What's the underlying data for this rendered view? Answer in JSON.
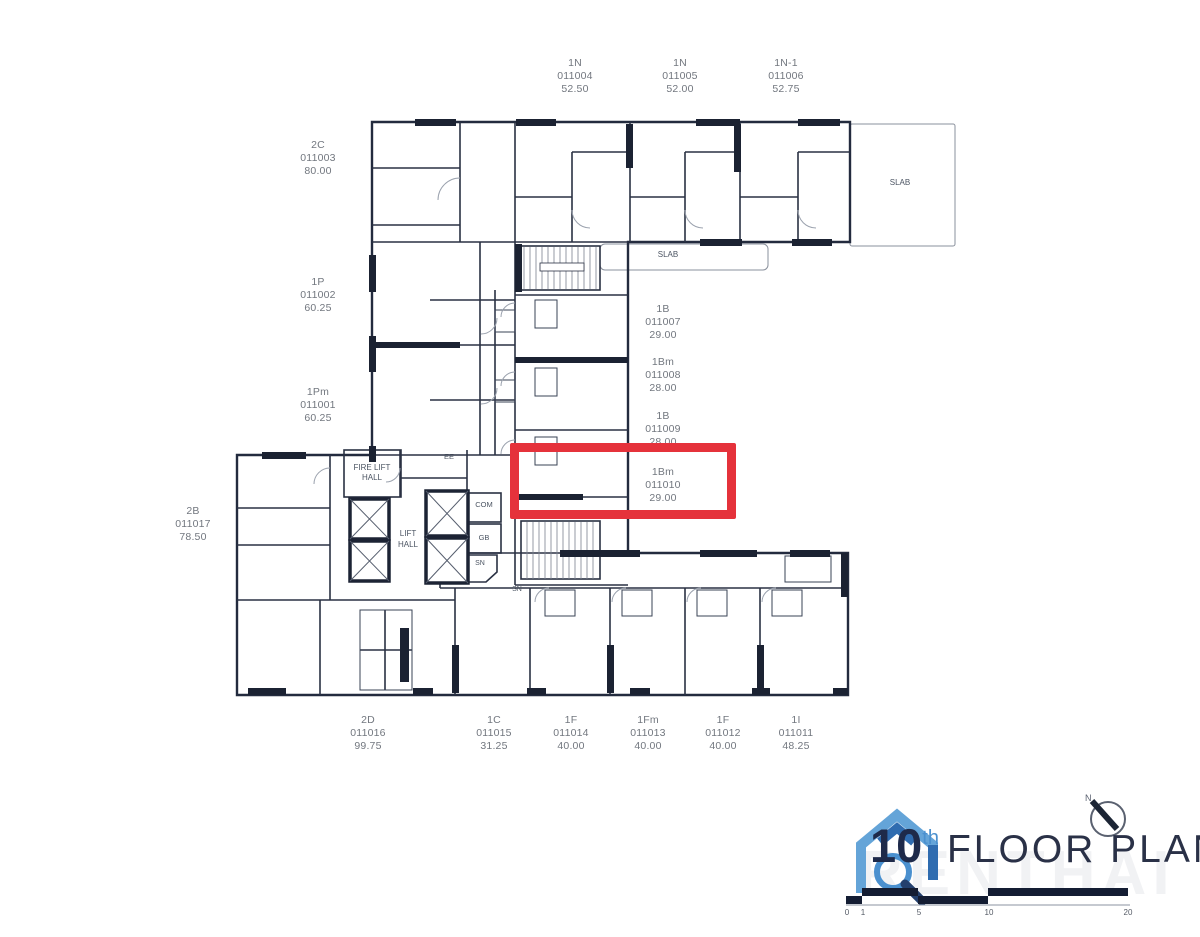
{
  "units": [
    {
      "code": "1N",
      "id": "011004",
      "area": "52.50"
    },
    {
      "code": "1N",
      "id": "011005",
      "area": "52.00"
    },
    {
      "code": "1N-1",
      "id": "011006",
      "area": "52.75"
    },
    {
      "code": "2C",
      "id": "011003",
      "area": "80.00"
    },
    {
      "code": "1P",
      "id": "011002",
      "area": "60.25"
    },
    {
      "code": "1Pm",
      "id": "011001",
      "area": "60.25"
    },
    {
      "code": "1B",
      "id": "011007",
      "area": "29.00"
    },
    {
      "code": "1Bm",
      "id": "011008",
      "area": "28.00"
    },
    {
      "code": "1B",
      "id": "011009",
      "area": "28.00"
    },
    {
      "code": "1Bm",
      "id": "011010",
      "area": "29.00"
    },
    {
      "code": "2B",
      "id": "011017",
      "area": "78.50"
    },
    {
      "code": "2D",
      "id": "011016",
      "area": "99.75"
    },
    {
      "code": "1C",
      "id": "011015",
      "area": "31.25"
    },
    {
      "code": "1F",
      "id": "011014",
      "area": "40.00"
    },
    {
      "code": "1Fm",
      "id": "011013",
      "area": "40.00"
    },
    {
      "code": "1F",
      "id": "011012",
      "area": "40.00"
    },
    {
      "code": "1I",
      "id": "011011",
      "area": "48.25"
    }
  ],
  "rooms": {
    "slab_upper": "SLAB",
    "slab_lower": "SLAB",
    "fire_lift_hall": "FIRE LIFT HALL",
    "lift_hall": "LIFT HALL",
    "com": "COM",
    "gb": "GB",
    "sn_upper": "SN",
    "sn_lower": "SN",
    "ee": "EE"
  },
  "footer": {
    "floor_number": "10",
    "floor_ordinal": "th",
    "floor_text": "FLOOR PLAN",
    "north": "N",
    "scale_ticks": [
      "0",
      "1",
      "5",
      "10",
      "20"
    ],
    "watermark": "RENTHAI"
  },
  "highlight": {
    "unit_id": "011010",
    "color": "#e5323b"
  },
  "colors": {
    "wall": "#232b3e",
    "thin": "#6a7080",
    "label_gray": "#72777f",
    "logo_blue": "#5d9fd6",
    "logo_navy": "#1f2a4a"
  }
}
